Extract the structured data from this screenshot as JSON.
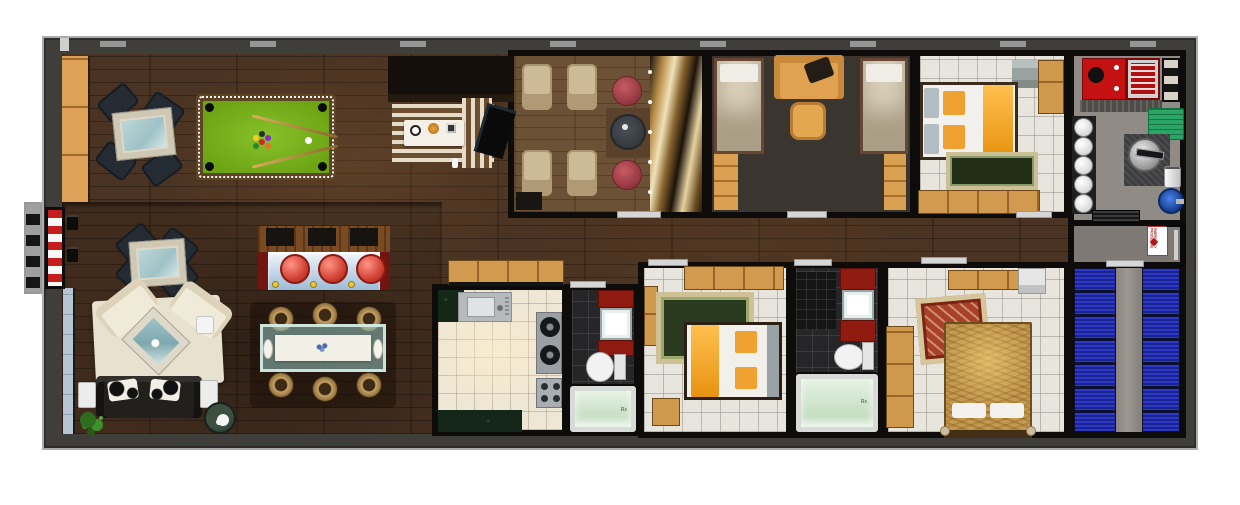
{
  "meta": {
    "type": "floor-plan",
    "description": "Top-down 3D rendered floor plan of a long, narrow residence (trailer-style) with games lounge, cinema lounge, bunk room, three bedrooms, two bathrooms, kitchen, bar, utility plant room and equipment bay",
    "canvas": {
      "width": 1240,
      "height": 505
    }
  },
  "palette": {
    "outer_wall": "#403e3b",
    "inner_wall": "#0d0c0b",
    "wood_dark": "#4a3322",
    "wood_mid": "#6b5236",
    "tile_light": "#e8e5df",
    "tile_dark": "#262628",
    "cabinet_tan": "#d29a4e",
    "felt_green": "#76b01e",
    "accent_red": "#c41212",
    "accent_green": "#2aa565",
    "rack_blue": "#2433b8",
    "bar_stool_red": "#d24236",
    "bed_orange": "#efa232",
    "shower_glass": "#cde4cc",
    "window_blue": "#b7c5d2"
  },
  "signs": {
    "emergency_text": "EMERGENCY PROCEDURE",
    "shower_mark": "Rx"
  },
  "rooms": [
    {
      "id": "games-lounge",
      "name": "Games lounge",
      "furniture": [
        "pool table",
        "card table with four chairs",
        "sideboard cabinet"
      ]
    },
    {
      "id": "tv-nook",
      "name": "TV nook",
      "furniture": [
        "corner sofa",
        "striped rug",
        "coffee table with snacks",
        "wall TV"
      ]
    },
    {
      "id": "home-cinema",
      "name": "Home cinema lounge",
      "furniture": [
        "four recliner armchairs",
        "round side table",
        "two red ottomans",
        "gilded feature wall"
      ]
    },
    {
      "id": "twin-bunk-room",
      "name": "Twin bunk room",
      "furniture": [
        "two single beds",
        "orange loveseat",
        "orange ottoman",
        "two orange runners"
      ]
    },
    {
      "id": "bedroom-1",
      "name": "Bedroom 1",
      "furniture": [
        "double bed with orange throw",
        "patterned rug",
        "wardrobe cabinets",
        "shelf unit"
      ]
    },
    {
      "id": "utility-room",
      "name": "Utility plant room",
      "furniture": [
        "red generator",
        "ladder rack",
        "green unit",
        "five round tanks",
        "round metal machine",
        "blue pump",
        "floor grate"
      ]
    },
    {
      "id": "vestibule",
      "name": "Entry vestibule",
      "furniture": [
        "emergency procedure sign",
        "door frame"
      ]
    },
    {
      "id": "living-room",
      "name": "Living room",
      "furniture": [
        "cream sofa set",
        "glass coffee table",
        "leather sofa with cowhide cushions",
        "side tables",
        "potted plant",
        "tea table"
      ]
    },
    {
      "id": "bar",
      "name": "Bar counter",
      "furniture": [
        "blue bar top",
        "three red stools",
        "back bar with mats"
      ]
    },
    {
      "id": "dining-area",
      "name": "Dining area",
      "furniture": [
        "glass dining table",
        "six wicker chairs",
        "white runner with platters"
      ]
    },
    {
      "id": "kitchen",
      "name": "Kitchen",
      "furniture": [
        "upper cabinets",
        "sink unit",
        "two-burner stove",
        "control panel",
        "granite counters"
      ]
    },
    {
      "id": "bathroom-1",
      "name": "Bathroom 1",
      "furniture": [
        "red vanity with sink",
        "toilet",
        "glass shower"
      ]
    },
    {
      "id": "bedroom-2",
      "name": "Bedroom 2",
      "furniture": [
        "double bed with orange throw",
        "green rug",
        "cabinets",
        "bench"
      ]
    },
    {
      "id": "bathroom-2",
      "name": "Bathroom 2",
      "furniture": [
        "dark vanity",
        "red cabinet with sink",
        "toilet",
        "glass shower"
      ]
    },
    {
      "id": "bedroom-3",
      "name": "Bedroom 3",
      "furniture": [
        "brocade double bed with white pillows",
        "red wall rug",
        "wardrobe",
        "shelf"
      ]
    },
    {
      "id": "equipment-bay",
      "name": "Equipment bay",
      "furniture": [
        "two rows of blue rack modules"
      ]
    },
    {
      "id": "corridor",
      "name": "Corridor",
      "furniture": []
    },
    {
      "id": "entry-steps",
      "name": "Entry steps",
      "furniture": [
        "hazard striped steps",
        "tread plate",
        "door hinges"
      ]
    }
  ]
}
